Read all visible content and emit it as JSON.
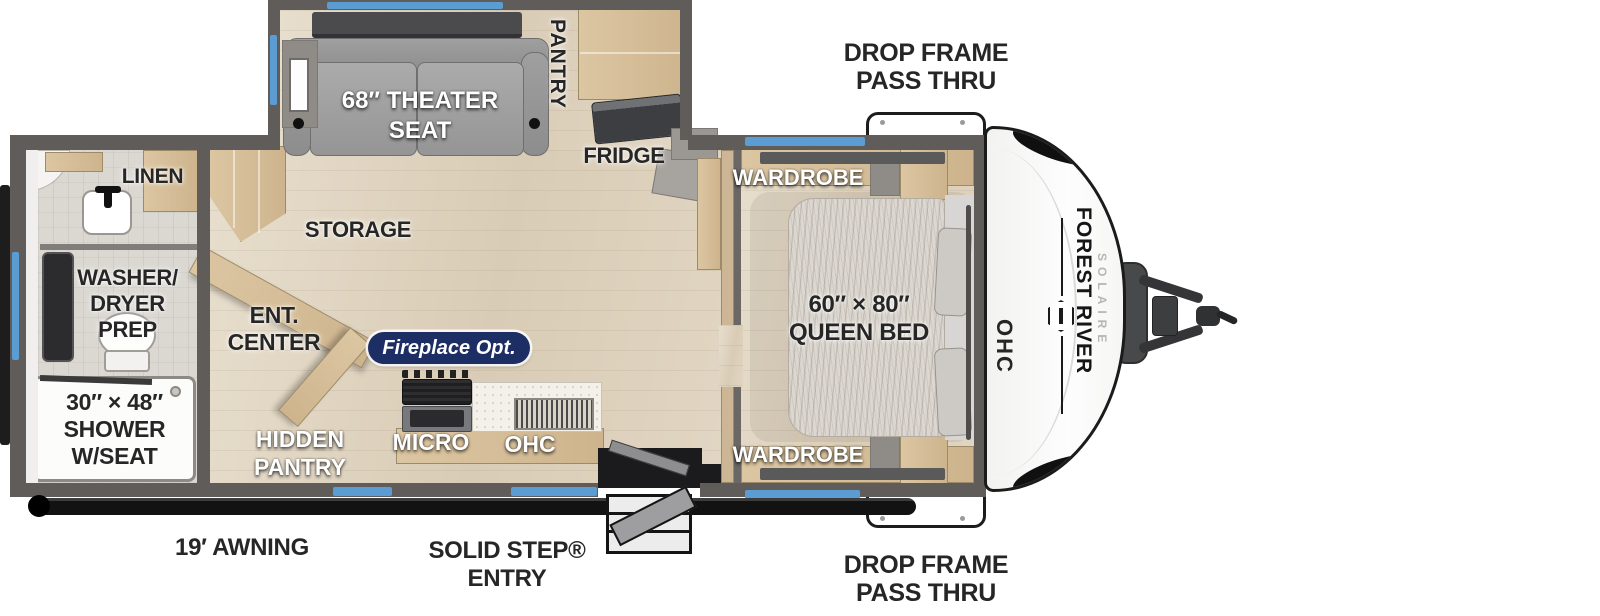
{
  "plan": {
    "brand": "FOREST RIVER",
    "model": "SOLAIRE",
    "labels": {
      "drop_frame_top": [
        "DROP FRAME",
        "PASS THRU"
      ],
      "drop_frame_bottom": [
        "DROP FRAME",
        "PASS THRU"
      ],
      "theater_seat": [
        "68″ THEATER",
        "SEAT"
      ],
      "pantry": "PANTRY",
      "fridge": "FRIDGE",
      "storage": "STORAGE",
      "linen": "LINEN",
      "washer_dryer_prep": [
        "WASHER/",
        "DRYER",
        "PREP"
      ],
      "shower": [
        "30″ × 48″",
        "SHOWER",
        "W/SEAT"
      ],
      "ent_center": [
        "ENT.",
        "CENTER"
      ],
      "hidden_pantry": [
        "HIDDEN",
        "PANTRY"
      ],
      "fireplace_option": "Fireplace Opt.",
      "micro": "MICRO",
      "ohc_kitchen": "OHC",
      "wardrobe_top": "WARDROBE",
      "wardrobe_bottom": "WARDROBE",
      "queen_bed": [
        "60″ × 80″",
        "QUEEN BED"
      ],
      "ohc_bedroom": "OHC",
      "awning": "19′ AWNING",
      "solid_step_entry": [
        "SOLID STEP®",
        "ENTRY"
      ]
    },
    "colors": {
      "window_blue": "#5b9dd2",
      "wall_gray": "#5f5c5a",
      "cabinet_tan": "#d7c09c",
      "badge_navy": "#1c2e63",
      "label_dark": "#262626",
      "awning_black": "#121212"
    }
  }
}
